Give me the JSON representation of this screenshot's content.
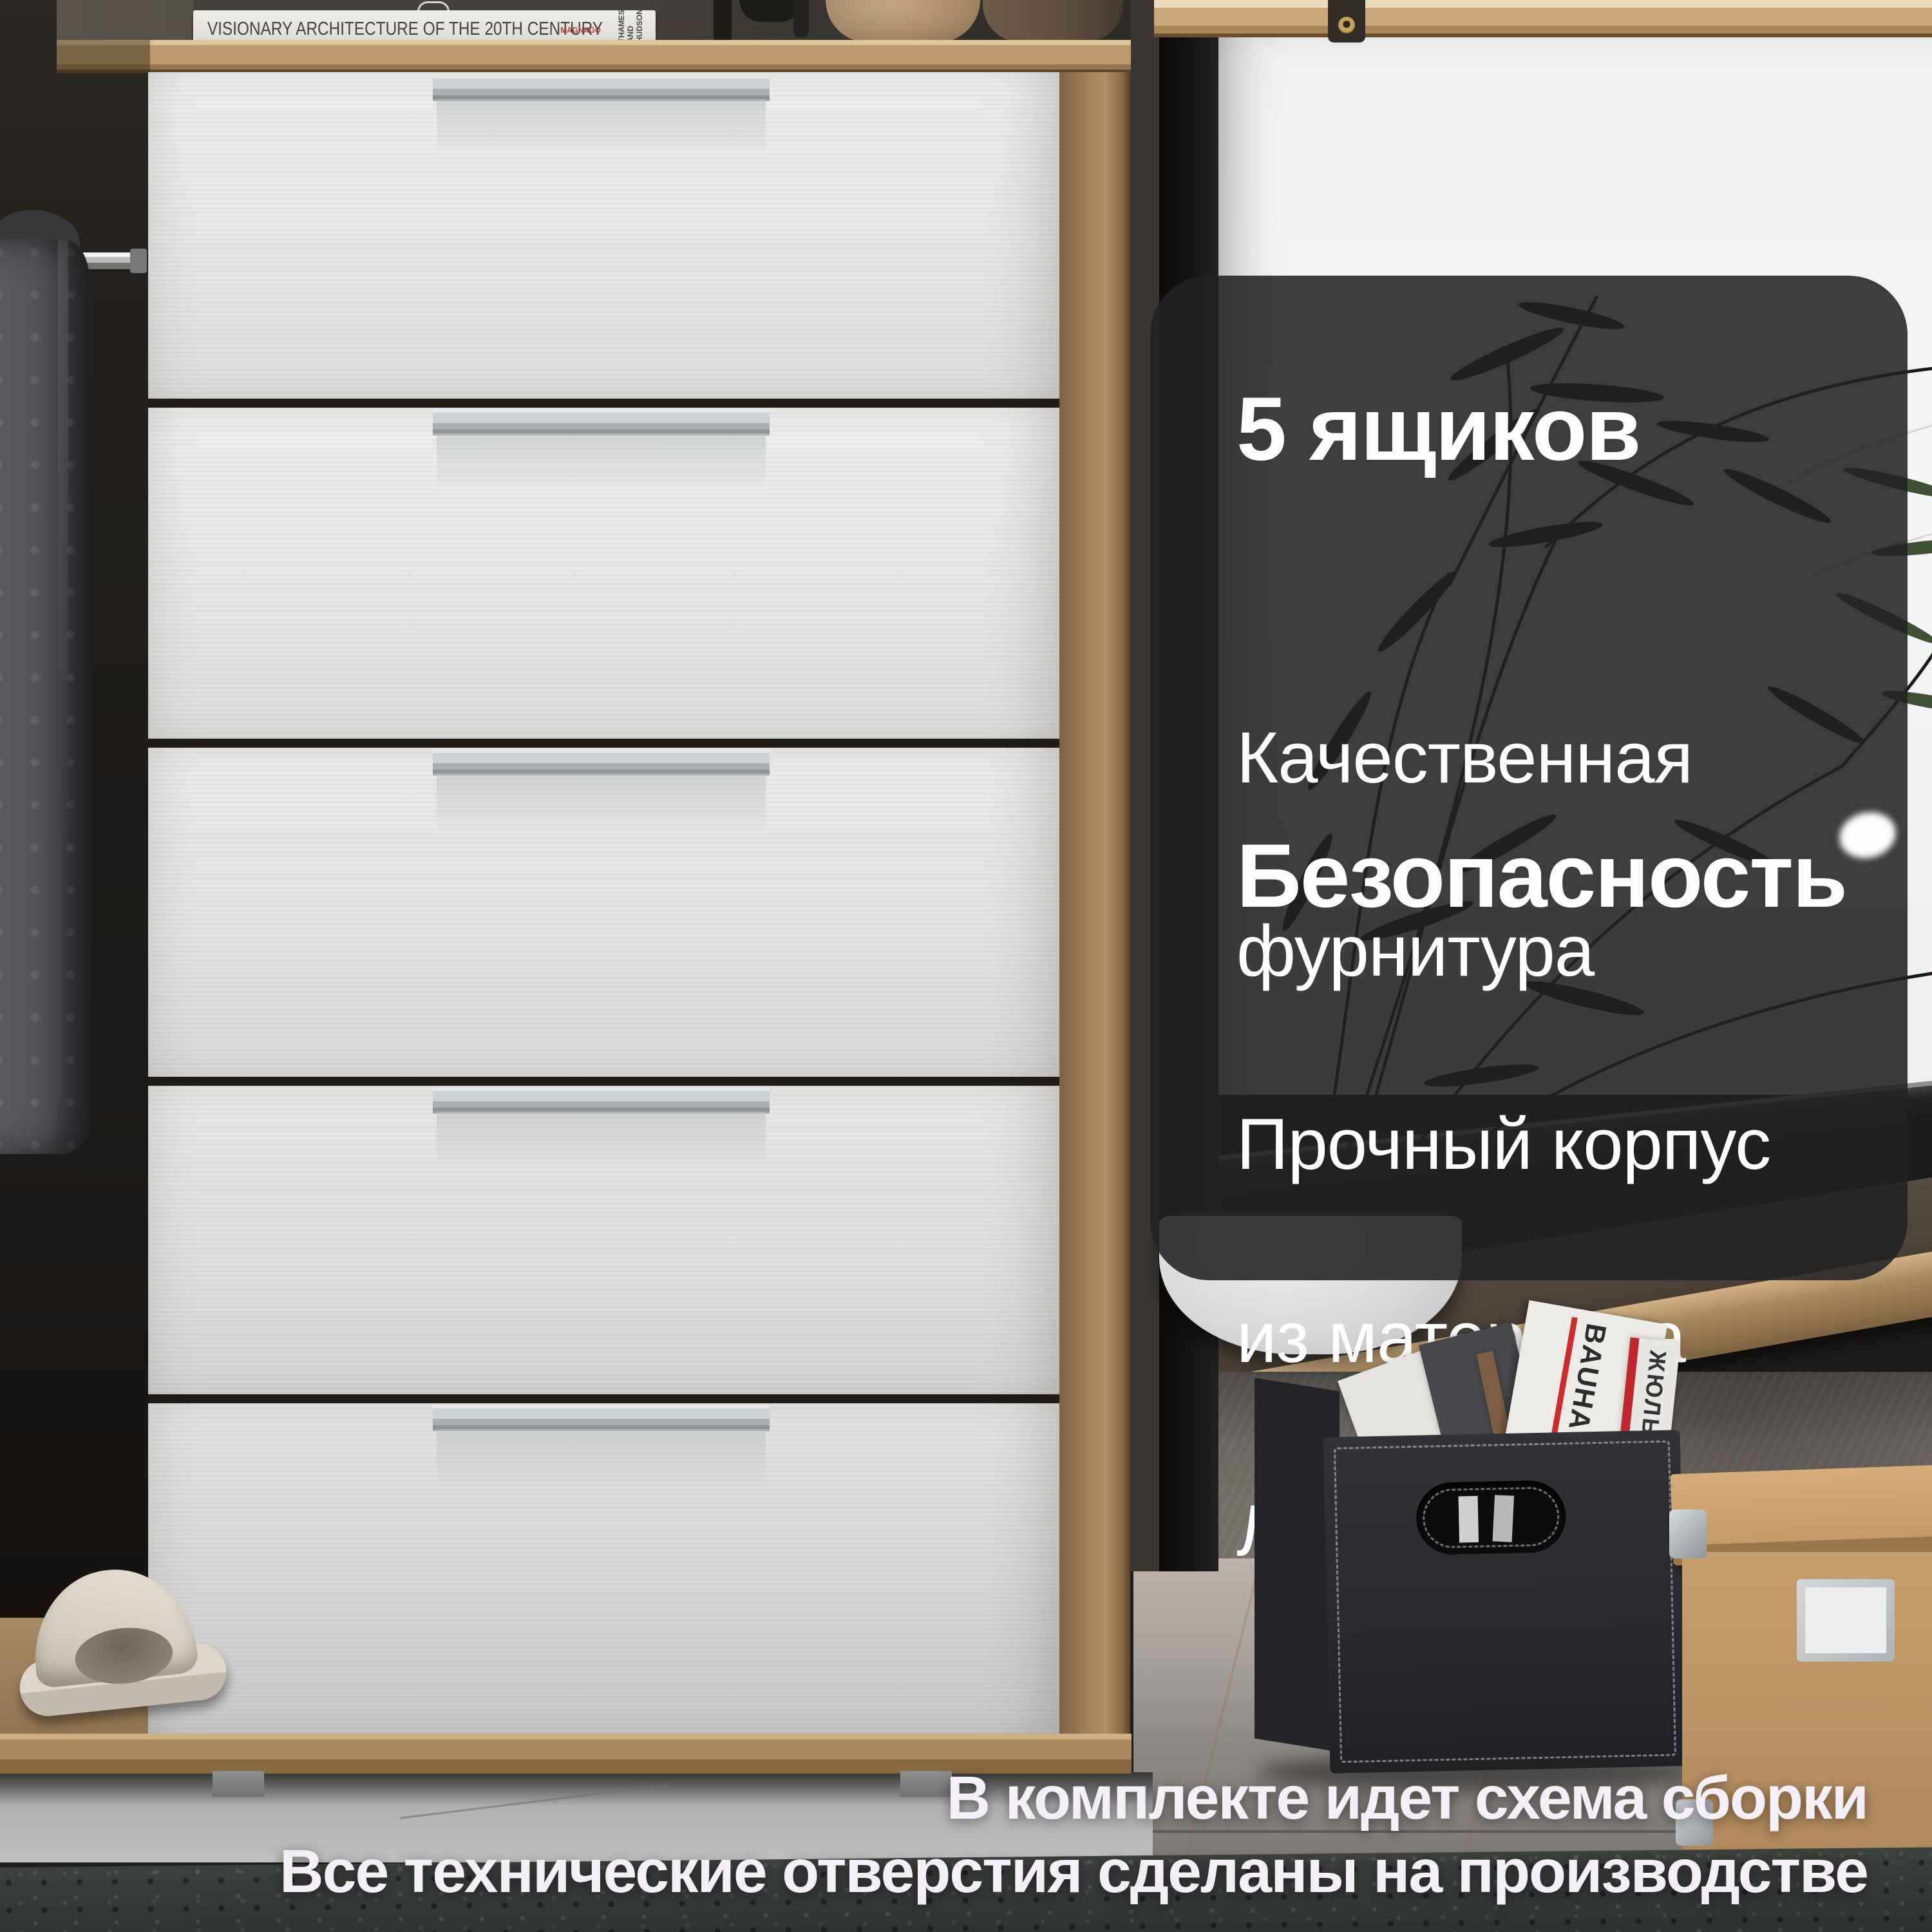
{
  "image_type": "furniture-product-card",
  "panel": {
    "heading1": "5 ящиков",
    "body1_line1": "Качественная",
    "body1_line2": "фурнитура",
    "heading2": "Безопасность",
    "body2_line1": "Прочный корпус",
    "body2_line2": "из материала",
    "body2_line3": "ЛДСП - 16 мм"
  },
  "captions": {
    "line1": "В комплекте идет схема сборки",
    "line2": "Все технические отверстия сделаны на производстве"
  },
  "props": {
    "book_title": "VISIONARY ARCHITECTURE OF THE 20TH CENTURY",
    "book_author_line1": "MAGNAGO",
    "book_author_line2": "LAMPUGNANI",
    "book_publisher": "THAMES AND HUDSON",
    "magazine_bauhaus": "BAUHAUS",
    "magazine_red_spine": "ЖЮЛЬ"
  },
  "furniture": {
    "drawers_count": 5,
    "drawer_front_color": "#e8e9e8",
    "body_wood_color": "#b2936c",
    "handle_color": "#c9cdd0"
  },
  "colors": {
    "overlay_panel": "#212124",
    "panel_text": "#fdfdfd",
    "window_light": "#f2f3f5",
    "caption_text": "#f4eff7",
    "accent_red_spine": "#c0272d"
  }
}
